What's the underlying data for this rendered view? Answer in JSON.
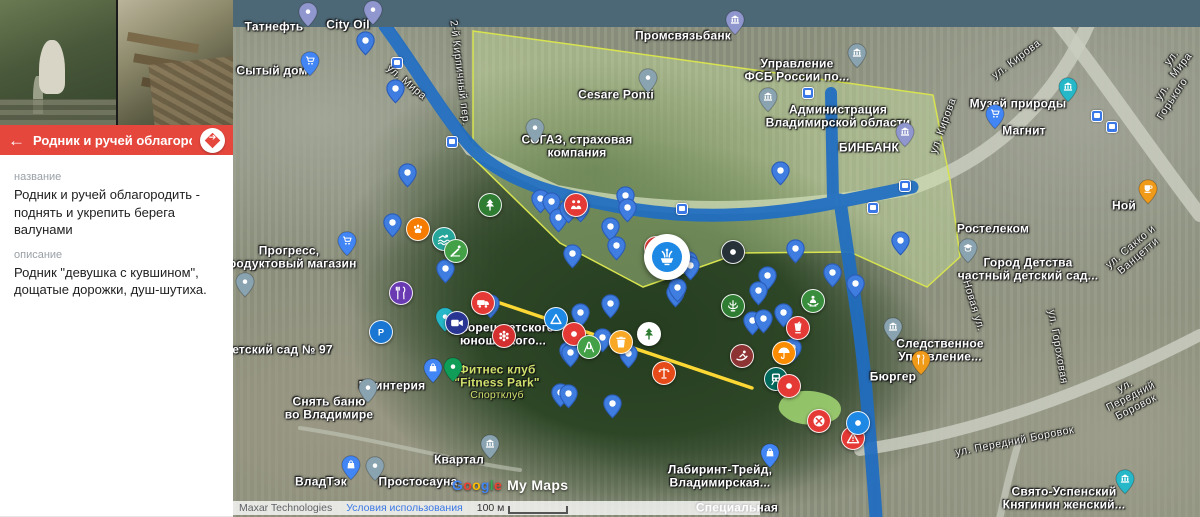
{
  "panel": {
    "photos": [
      {
        "name": "spring-statue-photo"
      },
      {
        "name": "wooden-walkway-photo"
      }
    ],
    "header": {
      "title": "Родник и ручей облагородить ...",
      "back_icon": "←",
      "color": "#e5473d"
    },
    "fields": [
      {
        "label": "название",
        "value": "Родник и ручей облагородить - поднять и укрепить берега валунами"
      },
      {
        "label": "описание",
        "value": "Родник \"девушка с кувшином\", дощатые дорожки, душ-шутиха."
      }
    ]
  },
  "attribution": {
    "map_data": "Maxar Technologies",
    "terms": "Условия использования",
    "scale": "100 м"
  },
  "watermark": {
    "brand": "Google",
    "brand_colors": [
      "#4285F4",
      "#EA4335",
      "#FBBC05",
      "#4285F4",
      "#34A853",
      "#EA4335"
    ],
    "product": "My Maps"
  },
  "colors": {
    "top_bar": "#4c6775",
    "panel_accent": "#e5473d",
    "default_pin": "#3f7ee0",
    "river_line": "#1f6dc2",
    "route_line": "#fdd835",
    "area_stroke": "#d7e34f"
  },
  "map": {
    "selected_marker": {
      "x": 667,
      "y": 257,
      "color": "#1e88e5",
      "icon": "fountain",
      "name": "selected-spring-marker"
    },
    "pins": [
      [
        365,
        55
      ],
      [
        395,
        103
      ],
      [
        407,
        187
      ],
      [
        392,
        237
      ],
      [
        445,
        283
      ],
      [
        540,
        213
      ],
      [
        551,
        216
      ],
      [
        558,
        232
      ],
      [
        568,
        223
      ],
      [
        580,
        222
      ],
      [
        610,
        241
      ],
      [
        625,
        210
      ],
      [
        627,
        222
      ],
      [
        616,
        260
      ],
      [
        572,
        268
      ],
      [
        675,
        278
      ],
      [
        688,
        275
      ],
      [
        690,
        280
      ],
      [
        675,
        307
      ],
      [
        677,
        302
      ],
      [
        795,
        263
      ],
      [
        767,
        290
      ],
      [
        758,
        305
      ],
      [
        783,
        327
      ],
      [
        752,
        335
      ],
      [
        763,
        333
      ],
      [
        792,
        362
      ],
      [
        602,
        352
      ],
      [
        568,
        365
      ],
      [
        628,
        368
      ],
      [
        612,
        418
      ],
      [
        560,
        407
      ],
      [
        568,
        408
      ],
      [
        790,
        398
      ],
      [
        832,
        287
      ],
      [
        855,
        298
      ],
      [
        900,
        255
      ],
      [
        780,
        185
      ],
      [
        490,
        318
      ],
      [
        580,
        327
      ],
      [
        610,
        318
      ],
      [
        570,
        367
      ]
    ],
    "poi_markers": [
      {
        "x": 308,
        "y": 27,
        "color": "#9097ce",
        "icon": "dot",
        "name": "gas-station-marker"
      },
      {
        "x": 373,
        "y": 25,
        "color": "#9097ce",
        "icon": "dot",
        "name": "gas-station-marker"
      },
      {
        "x": 735,
        "y": 35,
        "color": "#9097ce",
        "icon": "bank",
        "name": "bank-marker"
      },
      {
        "x": 905,
        "y": 147,
        "color": "#9097ce",
        "icon": "bank",
        "name": "bank-marker"
      },
      {
        "x": 310,
        "y": 76,
        "color": "#4285f4",
        "icon": "cart",
        "name": "store-marker"
      },
      {
        "x": 347,
        "y": 256,
        "color": "#4285f4",
        "icon": "cart",
        "name": "store-marker"
      },
      {
        "x": 995,
        "y": 129,
        "color": "#4285f4",
        "icon": "cart",
        "name": "store-marker"
      },
      {
        "x": 433,
        "y": 383,
        "color": "#4285f4",
        "icon": "bag",
        "name": "shop-marker"
      },
      {
        "x": 351,
        "y": 480,
        "color": "#4285f4",
        "icon": "bag",
        "name": "shop-marker"
      },
      {
        "x": 770,
        "y": 468,
        "color": "#4285f4",
        "icon": "bag",
        "name": "shop-marker"
      },
      {
        "x": 648,
        "y": 93,
        "color": "#8aa3b0",
        "icon": "dot",
        "name": "poi-marker"
      },
      {
        "x": 535,
        "y": 143,
        "color": "#8aa3b0",
        "icon": "dot",
        "name": "poi-marker"
      },
      {
        "x": 368,
        "y": 403,
        "color": "#8aa3b0",
        "icon": "dot",
        "name": "poi-marker"
      },
      {
        "x": 375,
        "y": 481,
        "color": "#8aa3b0",
        "icon": "dot",
        "name": "poi-marker"
      },
      {
        "x": 490,
        "y": 459,
        "color": "#8aa3b0",
        "icon": "bank",
        "name": "museum-marker"
      },
      {
        "x": 968,
        "y": 263,
        "color": "#8aa3b0",
        "icon": "cap",
        "name": "kindergarten-marker"
      },
      {
        "x": 245,
        "y": 297,
        "color": "#8aa3b0",
        "icon": "dot",
        "name": "poi-marker"
      },
      {
        "x": 857,
        "y": 68,
        "color": "#8aa3b0",
        "icon": "bank",
        "name": "government-marker"
      },
      {
        "x": 768,
        "y": 112,
        "color": "#8aa3b0",
        "icon": "bank",
        "name": "government-marker"
      },
      {
        "x": 893,
        "y": 342,
        "color": "#8aa3b0",
        "icon": "bank",
        "name": "government-marker"
      },
      {
        "x": 1068,
        "y": 102,
        "color": "#26b8c9",
        "icon": "bank",
        "name": "museum-marker"
      },
      {
        "x": 1125,
        "y": 494,
        "color": "#26b8c9",
        "icon": "bank",
        "name": "church-marker"
      },
      {
        "x": 921,
        "y": 375,
        "color": "#f09a1a",
        "icon": "utensils",
        "name": "restaurant-marker"
      },
      {
        "x": 1148,
        "y": 204,
        "color": "#f09a1a",
        "icon": "cup",
        "name": "cafe-marker"
      },
      {
        "x": 453,
        "y": 382,
        "color": "#0f9d58",
        "icon": "dot",
        "name": "fitness-marker"
      },
      {
        "x": 445,
        "y": 332,
        "color": "#26b8c9",
        "icon": "dot",
        "name": "palace-marker"
      }
    ],
    "circle_markers": [
      {
        "x": 417,
        "y": 228,
        "color": "#f57c00",
        "icon": "paw",
        "name": "animals-marker"
      },
      {
        "x": 443,
        "y": 238,
        "color": "#26a69a",
        "icon": "swim",
        "name": "swimming-marker"
      },
      {
        "x": 455,
        "y": 250,
        "color": "#43a047",
        "icon": "slide",
        "name": "slide-marker"
      },
      {
        "x": 489,
        "y": 204,
        "color": "#2e7d32",
        "icon": "tree",
        "name": "tree-marker"
      },
      {
        "x": 575,
        "y": 204,
        "color": "#e53935",
        "icon": "people",
        "name": "meeting-point-marker"
      },
      {
        "x": 655,
        "y": 247,
        "color": "#e53935",
        "icon": "dot",
        "name": "red-marker"
      },
      {
        "x": 732,
        "y": 251,
        "color": "#263238",
        "icon": "dot",
        "name": "black-marker"
      },
      {
        "x": 732,
        "y": 305,
        "color": "#2e7d32",
        "icon": "cascade",
        "name": "cascade-fountain-marker"
      },
      {
        "x": 400,
        "y": 292,
        "color": "#6a3ab2",
        "icon": "utensils",
        "name": "restaurant-marker"
      },
      {
        "x": 380,
        "y": 331,
        "color": "#1976d2",
        "icon": "P",
        "name": "parking-marker"
      },
      {
        "x": 482,
        "y": 302,
        "color": "#e53935",
        "icon": "van",
        "name": "camper-marker"
      },
      {
        "x": 456,
        "y": 322,
        "color": "#283593",
        "icon": "camera",
        "name": "video-marker"
      },
      {
        "x": 503,
        "y": 335,
        "color": "#d32f2f",
        "icon": "flower",
        "name": "carousel-marker"
      },
      {
        "x": 555,
        "y": 318,
        "color": "#1e88e5",
        "icon": "triangle",
        "name": "camp-marker"
      },
      {
        "x": 573,
        "y": 333,
        "color": "#e53935",
        "icon": "dot",
        "name": "red-marker"
      },
      {
        "x": 588,
        "y": 346,
        "color": "#43a047",
        "icon": "swing",
        "name": "swing-marker"
      },
      {
        "x": 620,
        "y": 341,
        "color": "#f9a825",
        "icon": "trash",
        "name": "trash-marker"
      },
      {
        "x": 648,
        "y": 333,
        "color": "#ffffff",
        "icon": "tree",
        "ic": "#2e7d32",
        "name": "white-tree-marker"
      },
      {
        "x": 663,
        "y": 372,
        "color": "#e64a19",
        "icon": "lamp",
        "name": "lamp-marker"
      },
      {
        "x": 741,
        "y": 355,
        "color": "#8d3333",
        "icon": "sled",
        "name": "sled-marker"
      },
      {
        "x": 783,
        "y": 352,
        "color": "#fb8c00",
        "icon": "umbrella",
        "name": "umbrella-marker"
      },
      {
        "x": 775,
        "y": 378,
        "color": "#00695c",
        "icon": "train",
        "name": "train-marker"
      },
      {
        "x": 788,
        "y": 385,
        "color": "#e53935",
        "icon": "dot",
        "name": "red-marker"
      },
      {
        "x": 812,
        "y": 300,
        "color": "#388e3c",
        "icon": "meditate",
        "name": "yoga-marker"
      },
      {
        "x": 797,
        "y": 327,
        "color": "#e53935",
        "icon": "drink",
        "name": "food-drink-marker"
      },
      {
        "x": 818,
        "y": 420,
        "color": "#e53935",
        "icon": "picnic",
        "name": "picnic-marker"
      },
      {
        "x": 852,
        "y": 437,
        "color": "#e53935",
        "icon": "warning",
        "name": "warning-marker"
      },
      {
        "x": 857,
        "y": 422,
        "color": "#1e88e5",
        "icon": "dot",
        "name": "blue-dot-marker"
      }
    ],
    "transit_stops": [
      [
        397,
        63
      ],
      [
        452,
        142
      ],
      [
        808,
        93
      ],
      [
        682,
        209
      ],
      [
        873,
        208
      ],
      [
        905,
        186
      ],
      [
        1097,
        116
      ],
      [
        1112,
        127
      ]
    ],
    "labels": [
      {
        "text": "Татнефть",
        "x": 274,
        "y": 27,
        "kind": "poi"
      },
      {
        "text": "City Oil",
        "x": 348,
        "y": 25,
        "kind": "poi"
      },
      {
        "text": "Сытый дом",
        "x": 272,
        "y": 71,
        "kind": "poi"
      },
      {
        "text": "Прогресс,\nпродуктовый магазин",
        "x": 289,
        "y": 258,
        "kind": "poi"
      },
      {
        "text": "Детский сад № 97",
        "x": 278,
        "y": 350,
        "kind": "poi"
      },
      {
        "text": "Промсвязьбанк",
        "x": 683,
        "y": 36,
        "kind": "poi"
      },
      {
        "text": "Cesare Ponti",
        "x": 616,
        "y": 95,
        "kind": "poi"
      },
      {
        "text": "СОГАЗ, страховая\nкомпания",
        "x": 577,
        "y": 147,
        "kind": "poi"
      },
      {
        "text": "Управление\nФСБ России по...",
        "x": 797,
        "y": 71,
        "kind": "poi"
      },
      {
        "text": "Администрация\nВладимирской области",
        "x": 838,
        "y": 117,
        "kind": "poi"
      },
      {
        "text": "БИНБАНК",
        "x": 869,
        "y": 148,
        "kind": "poi"
      },
      {
        "text": "Музей природы",
        "x": 1018,
        "y": 104,
        "kind": "poi"
      },
      {
        "text": "Магнит",
        "x": 1024,
        "y": 131,
        "kind": "poi"
      },
      {
        "text": "Ной",
        "x": 1124,
        "y": 206,
        "kind": "poi"
      },
      {
        "text": "Ростелеком",
        "x": 993,
        "y": 229,
        "kind": "poi"
      },
      {
        "text": "Город Детства\nчастный детский сад...",
        "x": 1028,
        "y": 270,
        "kind": "poi"
      },
      {
        "text": "Следственное\nУправление...",
        "x": 940,
        "y": 351,
        "kind": "poi"
      },
      {
        "text": "Бюргер",
        "x": 893,
        "y": 377,
        "kind": "poi"
      },
      {
        "text": "Лабиринт-Трейд,\nВладимирская...",
        "x": 720,
        "y": 477,
        "kind": "poi"
      },
      {
        "text": "Свято-Успенский\nКнягинин женский...",
        "x": 1064,
        "y": 499,
        "kind": "poi"
      },
      {
        "text": "Квартал",
        "x": 459,
        "y": 460,
        "kind": "poi"
      },
      {
        "text": "Фитнес клуб\n\"Fitness Park\"",
        "x": 497,
        "y": 377,
        "kind": "green"
      },
      {
        "text": "Спортклуб",
        "x": 497,
        "y": 396,
        "kind": "gsmall"
      },
      {
        "text": "Принтерия",
        "x": 392,
        "y": 386,
        "kind": "poi"
      },
      {
        "text": "Снять баню\nво Владимире",
        "x": 329,
        "y": 409,
        "kind": "poi"
      },
      {
        "text": "ВладТэк",
        "x": 321,
        "y": 482,
        "kind": "poi"
      },
      {
        "text": "Простосауна",
        "x": 418,
        "y": 482,
        "kind": "poi"
      },
      {
        "text": "Дворец детского\nюношеского...",
        "x": 503,
        "y": 335,
        "kind": "poi"
      },
      {
        "text": "Специальная",
        "x": 737,
        "y": 508,
        "kind": "poi"
      },
      {
        "text": "ул. Мира",
        "x": 406,
        "y": 83,
        "kind": "street",
        "rot": 40
      },
      {
        "text": "2-й Кирпичный пер.",
        "x": 459,
        "y": 73,
        "kind": "street",
        "rot": 83
      },
      {
        "text": "ул. Кирова",
        "x": 1017,
        "y": 60,
        "kind": "street",
        "rot": -37
      },
      {
        "text": "ул. Кирова",
        "x": 944,
        "y": 126,
        "kind": "street",
        "rot": -70
      },
      {
        "text": "ул. Мира",
        "x": 1177,
        "y": 62,
        "kind": "street",
        "rot": -52
      },
      {
        "text": "ул. Горького",
        "x": 1168,
        "y": 96,
        "kind": "street",
        "rot": -57
      },
      {
        "text": "Новая ул.",
        "x": 973,
        "y": 306,
        "kind": "street",
        "rot": 73
      },
      {
        "text": "ул. Передний Боровок",
        "x": 1015,
        "y": 442,
        "kind": "street",
        "rot": -11
      },
      {
        "text": "ул. Передний Боровок",
        "x": 1131,
        "y": 397,
        "kind": "street",
        "rot": -27
      },
      {
        "text": "ул. Гороховая",
        "x": 1057,
        "y": 347,
        "kind": "street",
        "rot": 80
      },
      {
        "text": "ул. Сакко и Ванцетти",
        "x": 1135,
        "y": 252,
        "kind": "street",
        "rot": -40
      }
    ]
  }
}
